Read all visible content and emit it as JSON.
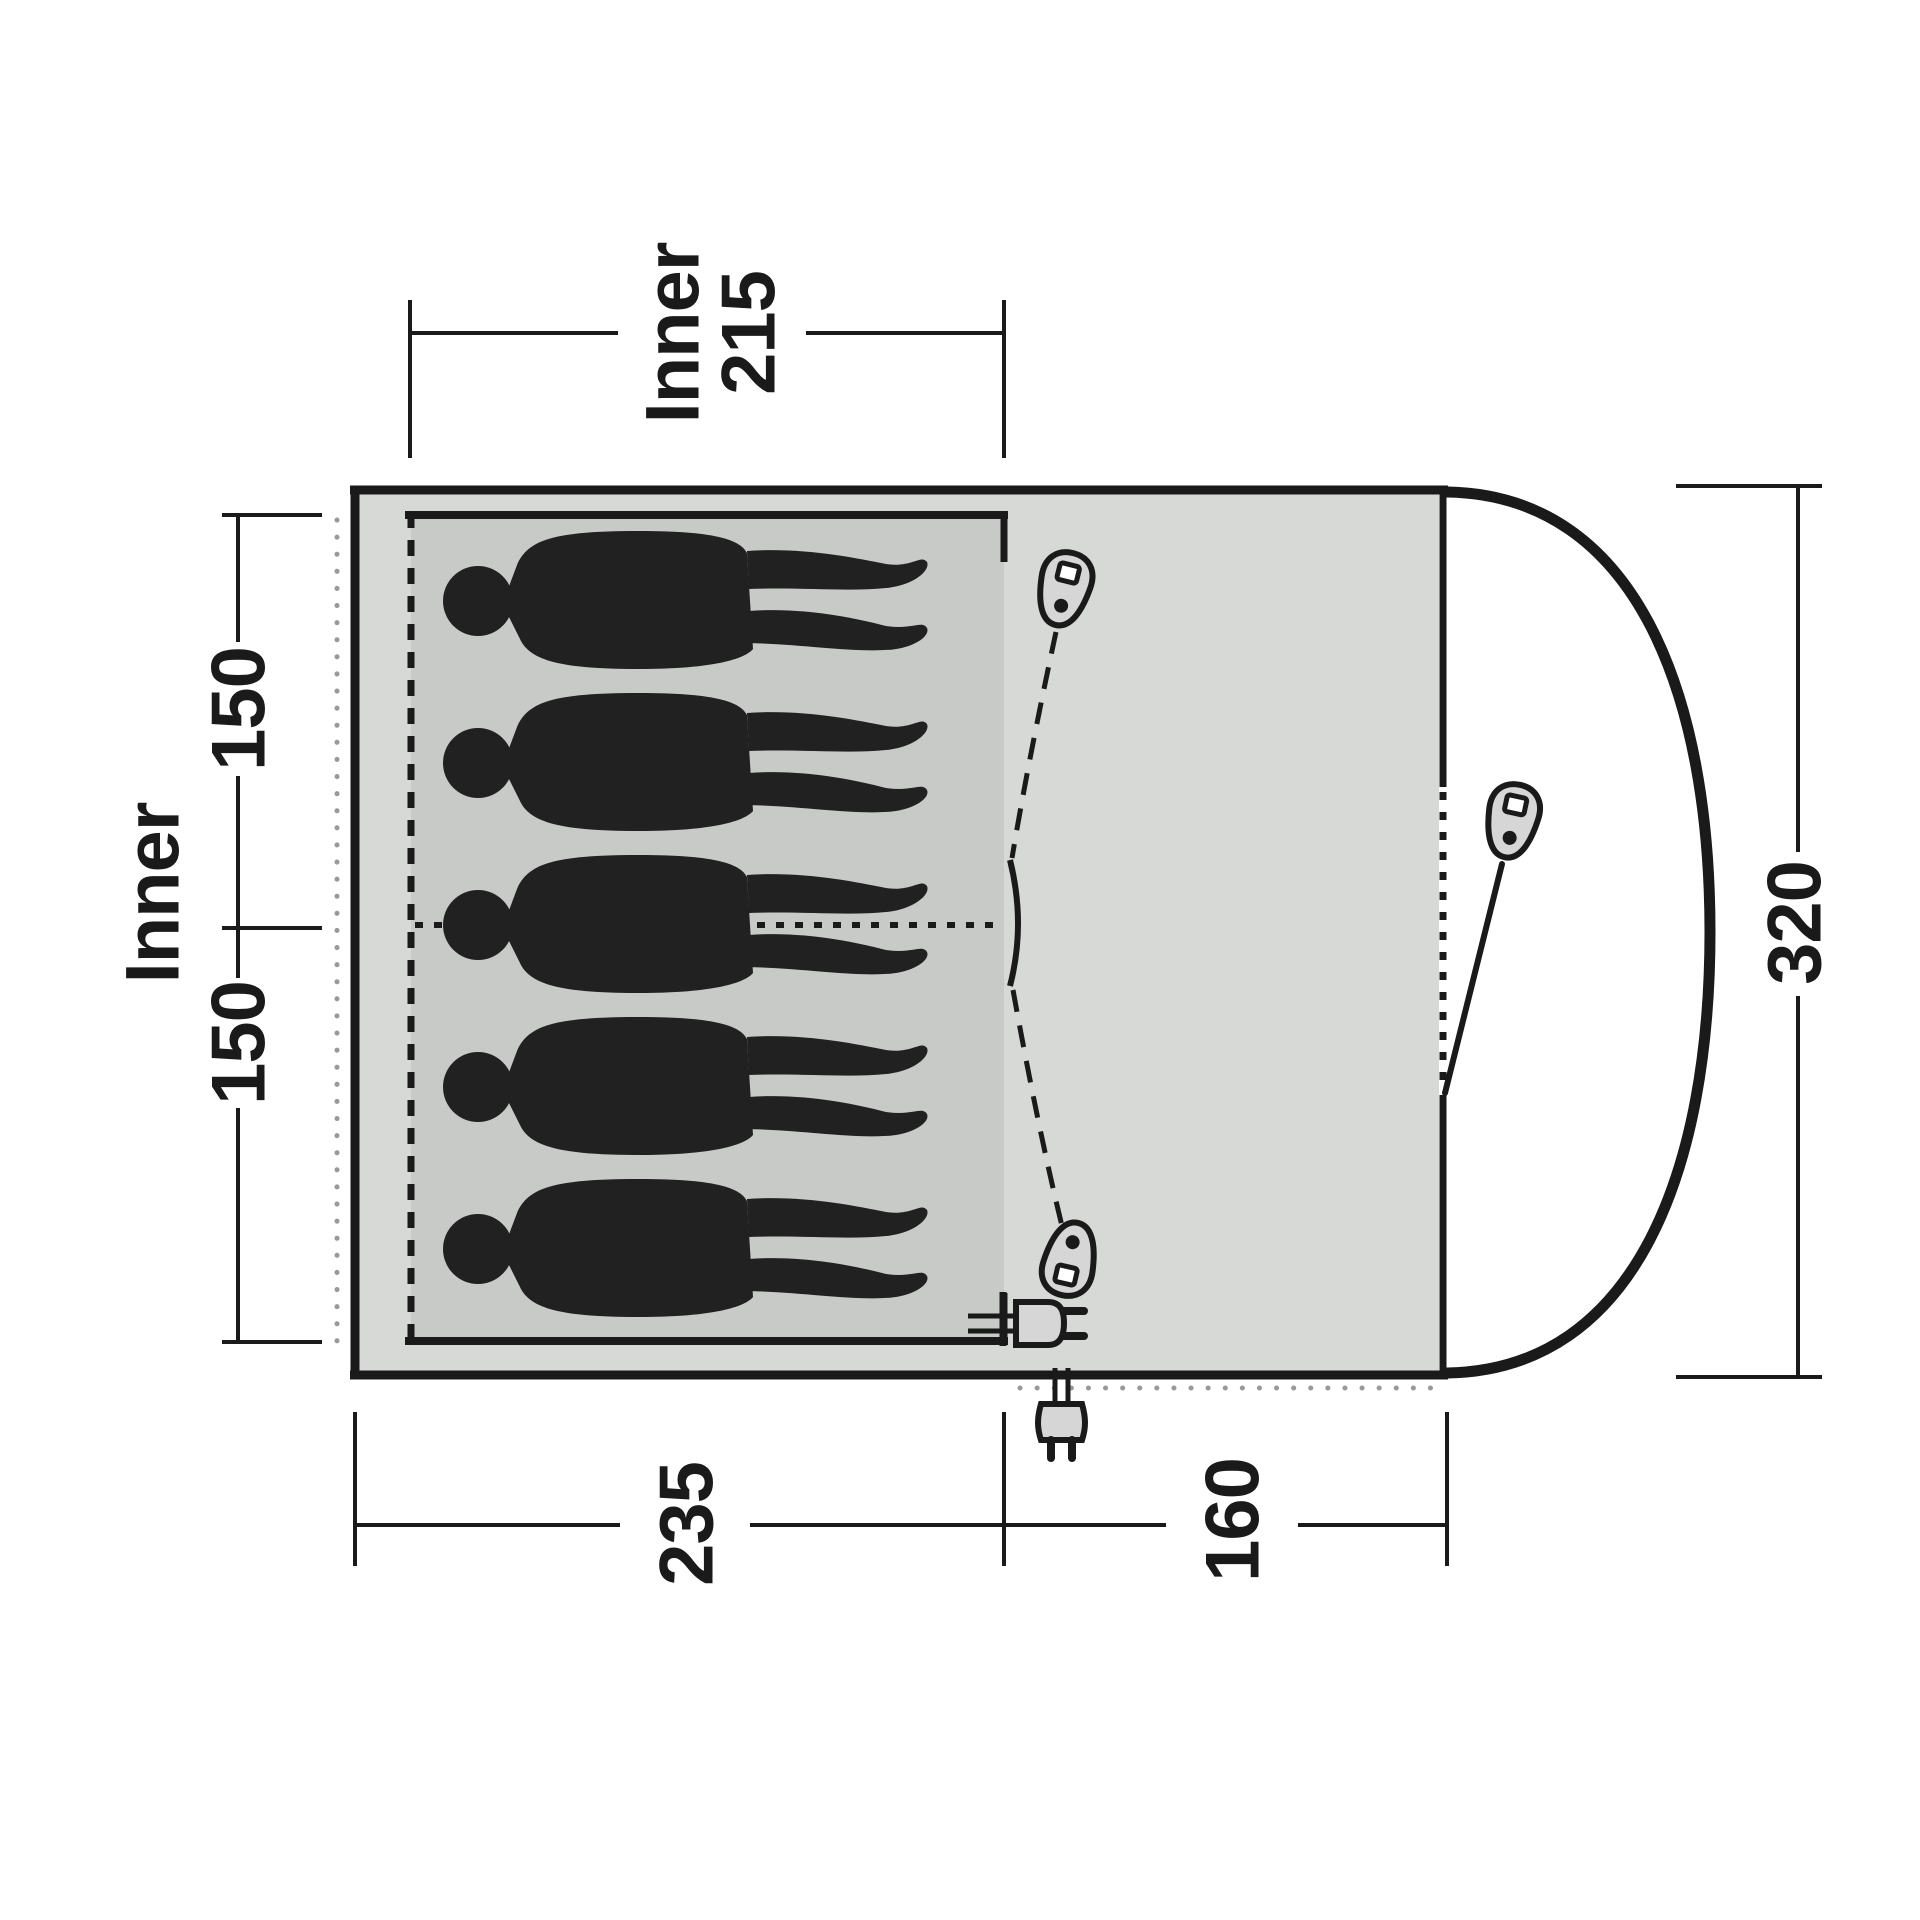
{
  "diagram": {
    "kind": "tent-floorplan-top-view",
    "occupant_count": 5,
    "labels": {
      "top_width_line1": "Inner",
      "top_width_line2": "215",
      "left_title": "Inner",
      "left_upper_depth": "150",
      "left_lower_depth": "150",
      "right_height": "320",
      "bottom_left_width": "235",
      "bottom_right_width": "160"
    },
    "icons": {
      "zipper_pulls": [
        "zipper-pull-icon-inner-top",
        "zipper-pull-icon-inner-bottom",
        "zipper-pull-icon-front-door"
      ],
      "plugs": [
        "power-plug-icon-inside",
        "power-plug-icon-outside"
      ]
    },
    "colors": {
      "outline": "#1a1a1a",
      "tent_fill": "#d7d9d6",
      "inner_fill": "#c7cac7",
      "silhouette": "#212121",
      "icon_fill": "#d6d6d6",
      "guide_dot": "#999999",
      "text": "#1a1a1a"
    }
  }
}
